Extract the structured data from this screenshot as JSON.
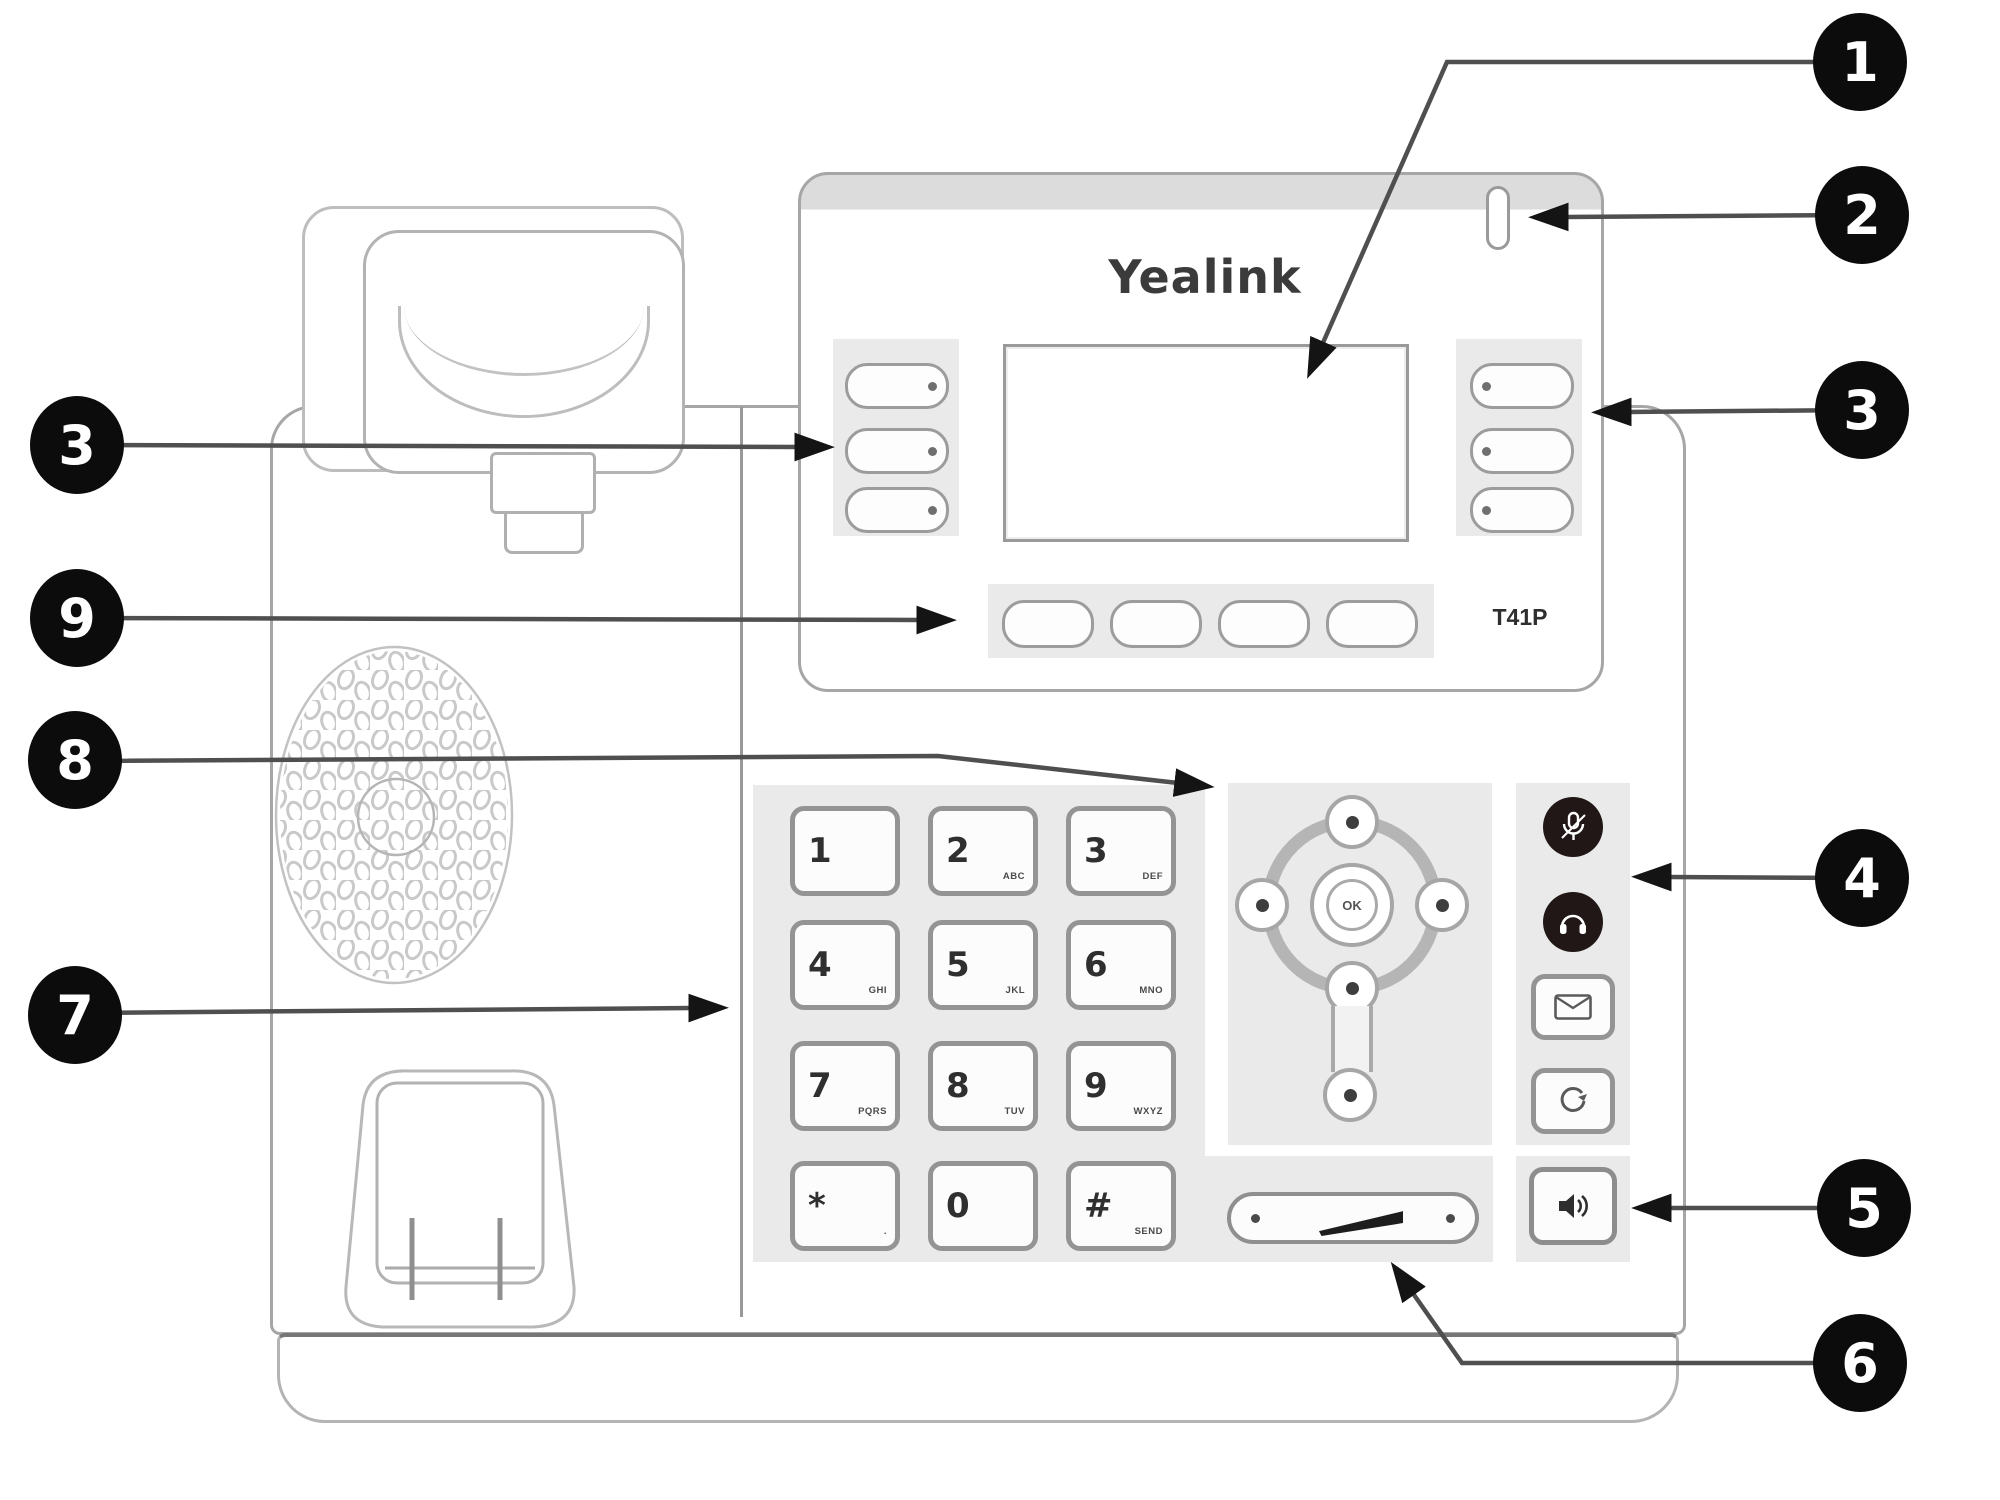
{
  "diagram": {
    "type": "phone-hardware-callout-diagram"
  },
  "phone": {
    "brand_logo": "Yealink",
    "model_label": "T41P",
    "nav": {
      "center_label": "OK"
    },
    "line_keys_left": 3,
    "line_keys_right": 3,
    "soft_keys": 4,
    "keypad": [
      {
        "digit": "1",
        "letters": ""
      },
      {
        "digit": "2",
        "letters": "ABC"
      },
      {
        "digit": "3",
        "letters": "DEF"
      },
      {
        "digit": "4",
        "letters": "GHI"
      },
      {
        "digit": "5",
        "letters": "JKL"
      },
      {
        "digit": "6",
        "letters": "MNO"
      },
      {
        "digit": "7",
        "letters": "PQRS"
      },
      {
        "digit": "8",
        "letters": "TUV"
      },
      {
        "digit": "9",
        "letters": "WXYZ"
      },
      {
        "digit": "*",
        "letters": "."
      },
      {
        "digit": "0",
        "letters": ""
      },
      {
        "digit": "#",
        "letters": "SEND"
      }
    ],
    "function_icons": [
      "mute-icon",
      "headset-icon",
      "message-icon",
      "redial-icon"
    ],
    "speaker_icon": "speakerphone-icon",
    "volume_icons": [
      "volume-down-dot",
      "volume-wedge",
      "volume-up-dot"
    ],
    "colors": {
      "callout_ball": "#0c0c0c",
      "callout_line": "#4f4f4f",
      "panel": "#eaeaea",
      "dark_key": "#221717"
    }
  },
  "callouts": [
    {
      "num": "1",
      "points_to": "lcd-screen"
    },
    {
      "num": "2",
      "points_to": "power-led-indicator"
    },
    {
      "num": "3",
      "points_to": "line-keys-right"
    },
    {
      "num": "3",
      "points_to": "line-keys-left"
    },
    {
      "num": "9",
      "points_to": "soft-keys"
    },
    {
      "num": "8",
      "points_to": "navigation-keys"
    },
    {
      "num": "7",
      "points_to": "keypad"
    },
    {
      "num": "4",
      "points_to": "function-keys"
    },
    {
      "num": "5",
      "points_to": "speakerphone-key"
    },
    {
      "num": "6",
      "points_to": "volume-key"
    }
  ]
}
